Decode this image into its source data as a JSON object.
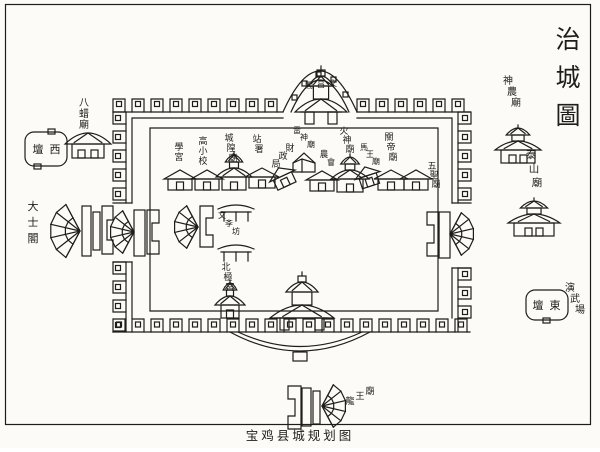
{
  "colors": {
    "paper": "#fcfbf7",
    "ink": "#1f1d1a"
  },
  "title": "治城圖",
  "caption": "宝鸡县城规划图",
  "outside": {
    "bazha_temple": "八蜡廟",
    "west_altar": {
      "name": "西壇",
      "display": "壇西"
    },
    "dashi_pavilion": "大士閣",
    "shennong_temple": "神農廟",
    "taishan_temple": "泰山廟",
    "east_altar": {
      "name": "東壇",
      "display": "壇東"
    },
    "drill_ground": "演武場",
    "longwang_temple": "龍王廟"
  },
  "gates": {
    "north_tower": {
      "name": "文昌閣",
      "display": "閣昌文"
    }
  },
  "inner": {
    "xuegong": "學宮",
    "gaoxiao_school": "高小校",
    "chenghuang_temple": "城隍廟",
    "zhan_shu": "站署",
    "caizheng_ju": "財政局",
    "leishen_temple": "雷神廟",
    "nong_hui": "農會",
    "huoshen_temple": "火神廟",
    "mawang_temple": "馬王廟",
    "guandi_temple": "關帝廟",
    "wusheng_temple": "五聖廟",
    "wenxue_fang": "文斈坊",
    "beiji_gong": "北極宮"
  }
}
